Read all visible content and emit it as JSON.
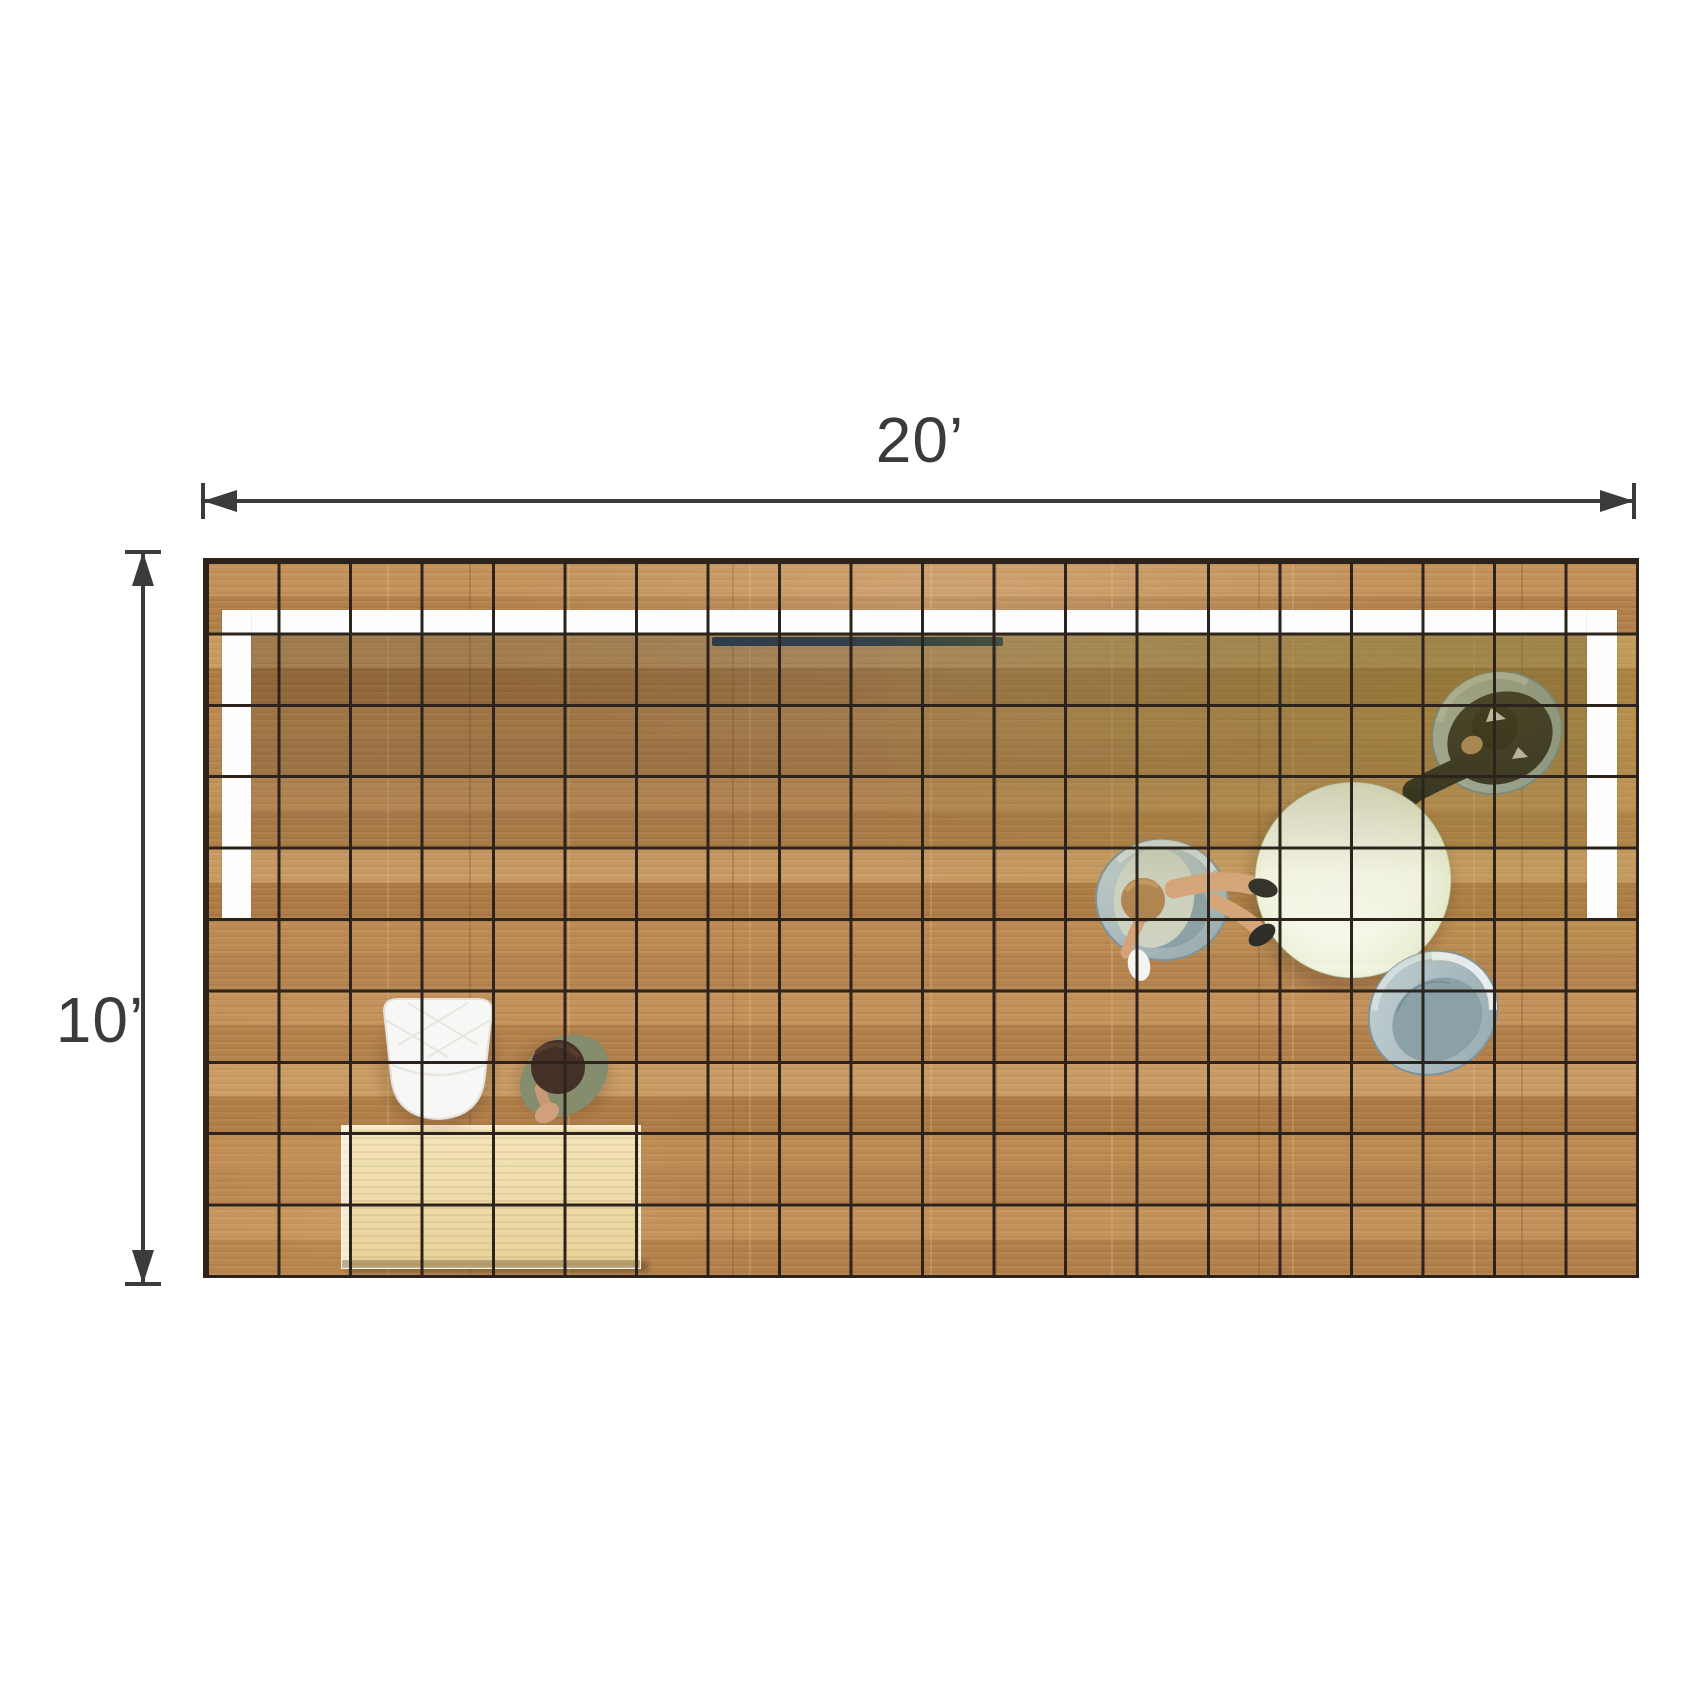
{
  "diagram": {
    "type": "trade-show-booth-floor-plan-top-view",
    "dimensions": {
      "width_label": "20’",
      "depth_label": "10’",
      "width_feet": 20,
      "depth_feet": 10
    },
    "grid": {
      "columns": 20,
      "rows": 10,
      "cell_feet": 1
    },
    "palette": {
      "background": "#ffffff",
      "dimension_color": "#3b3b3b",
      "grid_line": "#2c241c",
      "floor_wood": "#bf8d55",
      "desk_wood": "#eed9a4",
      "wall_white": "#fdfdfd",
      "table_white": "#f7fbef",
      "chair_gray": "#a5b8bd",
      "suit_black": "#1b1b20",
      "screen_dark": "#32414a",
      "canopy_shadow": "rgba(64,52,28,0.32)"
    },
    "objects": [
      {
        "name": "back-wall-panel"
      },
      {
        "name": "left-return-wall"
      },
      {
        "name": "right-return-wall"
      },
      {
        "name": "wall-mounted-screen"
      },
      {
        "name": "round-meeting-table"
      },
      {
        "name": "tub-chair-with-seated-woman"
      },
      {
        "name": "tub-chair-with-seated-man"
      },
      {
        "name": "empty-tub-chair"
      },
      {
        "name": "white-lounge-chair"
      },
      {
        "name": "kneeling-person"
      },
      {
        "name": "reception-desk"
      }
    ]
  }
}
